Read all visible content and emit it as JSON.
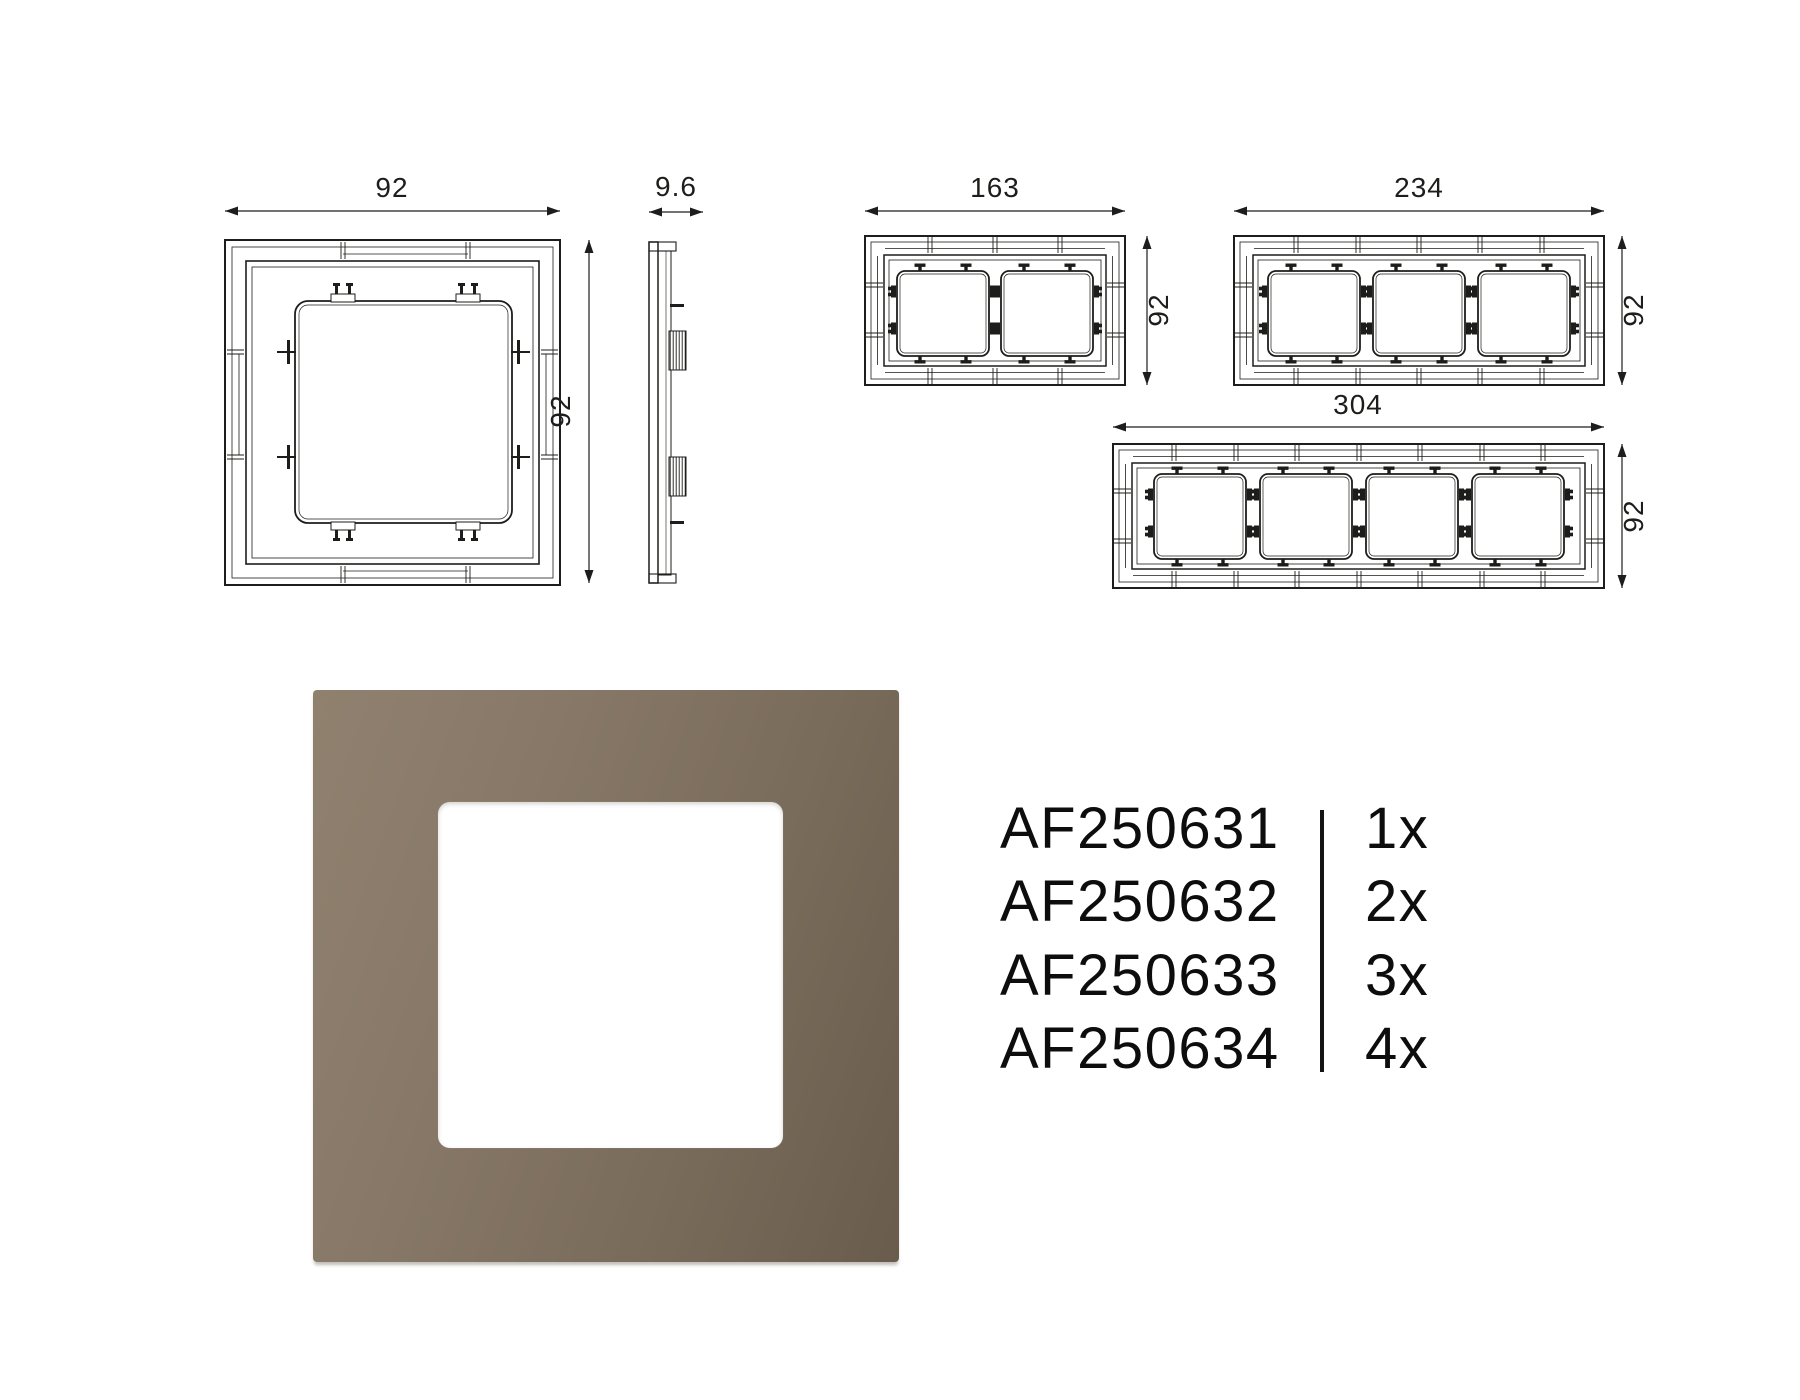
{
  "page": {
    "background": "#ffffff"
  },
  "technical_drawings": {
    "one_gang_front": {
      "width_mm": "92",
      "height_mm": "92"
    },
    "side_profile": {
      "depth_mm": "9.6"
    },
    "two_gang_front": {
      "width_mm": "163",
      "height_mm": "92"
    },
    "three_gang_front": {
      "width_mm": "234",
      "height_mm": "92"
    },
    "four_gang_front": {
      "width_mm": "304",
      "height_mm": "92"
    }
  },
  "product_table": {
    "rows": [
      {
        "code": "AF250631",
        "quantity": "1x"
      },
      {
        "code": "AF250632",
        "quantity": "2x"
      },
      {
        "code": "AF250633",
        "quantity": "3x"
      },
      {
        "code": "AF250634",
        "quantity": "4x"
      }
    ]
  },
  "product_render": {
    "frame_color_light": "#90816f",
    "frame_color_mid": "#796b5a",
    "frame_color_dark": "#695c4d",
    "window_color": "#ffffff",
    "line_color": "#1d1d1b"
  }
}
